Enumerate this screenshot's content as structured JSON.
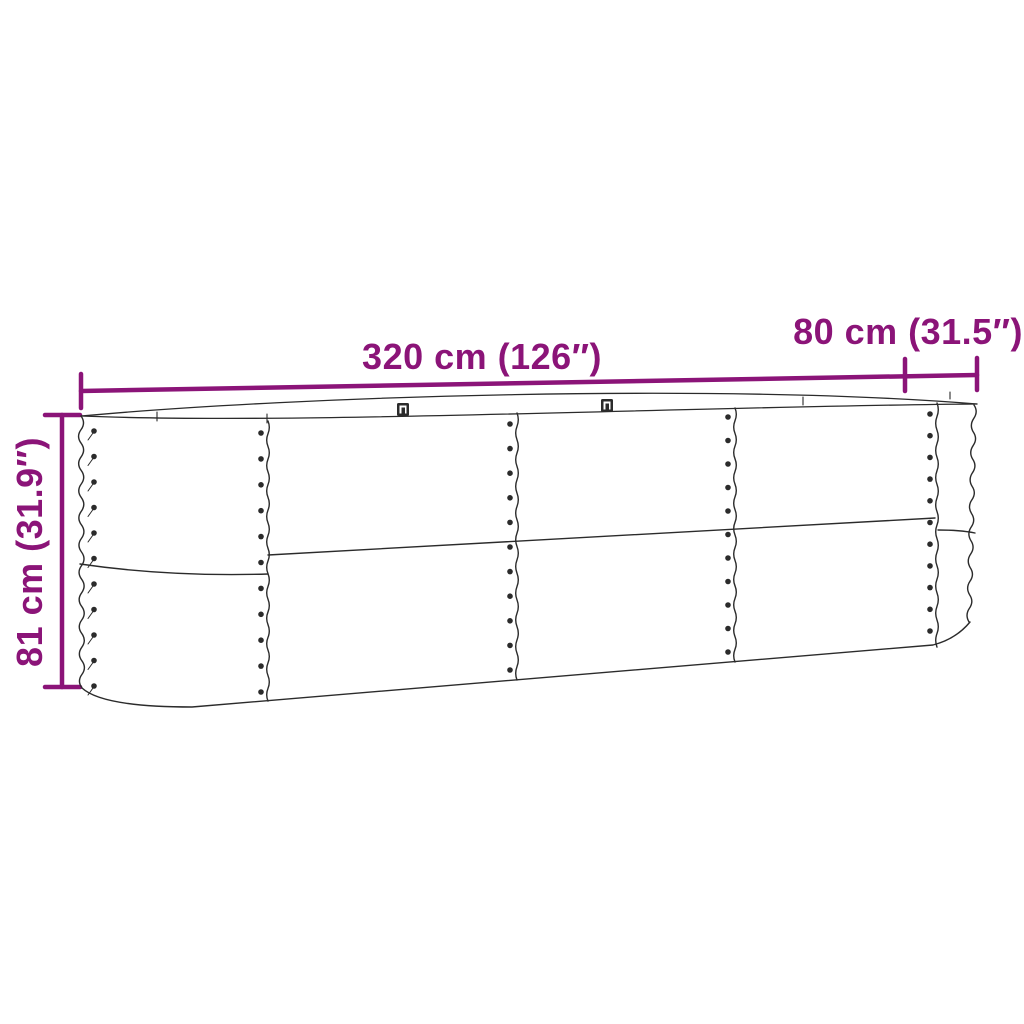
{
  "diagram": {
    "kind": "product-dimension-diagram",
    "subject": "oval corrugated-steel raised garden bed",
    "labels": {
      "length": "320 cm (126″)",
      "width": "80 cm (31.5″)",
      "height": "81 cm (31.9″)"
    },
    "colors": {
      "accent": "#8B1478",
      "line": "#2B2B2B",
      "background": "#FFFFFF"
    }
  }
}
